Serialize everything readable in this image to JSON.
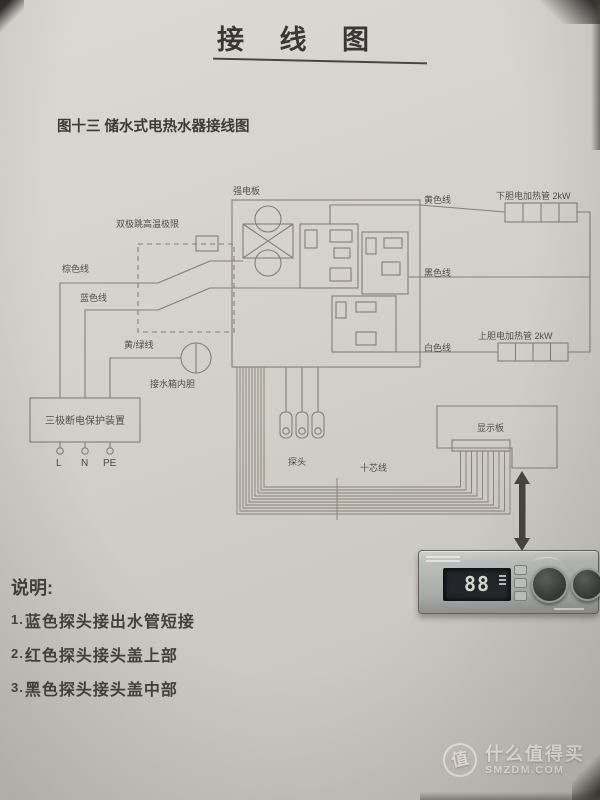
{
  "page": {
    "title": "接 线 图",
    "caption": "图十三  储水式电热水器接线图"
  },
  "diagram": {
    "labels": {
      "power_board": "强电板",
      "bipolar_limit": "双极跳高温极限",
      "brown_wire": "棕色线",
      "blue_wire": "蓝色线",
      "yellow_green_wire": "黄/绿线",
      "tank_liner": "接水箱内胆",
      "protector": "三极断电保护装置",
      "terminal_l": "L",
      "terminal_n": "N",
      "terminal_pe": "PE",
      "yellow_wire": "黄色线",
      "lower_heater": "下胆电加热管 2kW",
      "black_wire": "黑色线",
      "upper_heater": "上胆电加热管 2kW",
      "white_wire": "白色线",
      "probes": "探头",
      "ten_core_wire": "十芯线",
      "display_board": "显示板"
    },
    "panel": {
      "display_value": "88"
    }
  },
  "notes": {
    "heading": "说明:",
    "items": [
      {
        "num": "1.",
        "text": "蓝色探头接出水管短接"
      },
      {
        "num": "2.",
        "text": "红色探头接头盖上部"
      },
      {
        "num": "3.",
        "text": "黑色探头接头盖中部"
      }
    ]
  },
  "watermark": {
    "logo_char": "值",
    "name": "什么值得买",
    "site": "SMZDM.COM"
  },
  "colors": {
    "paper": "#d5d1cc",
    "ink": "#3a3834",
    "line": "#857f74"
  }
}
